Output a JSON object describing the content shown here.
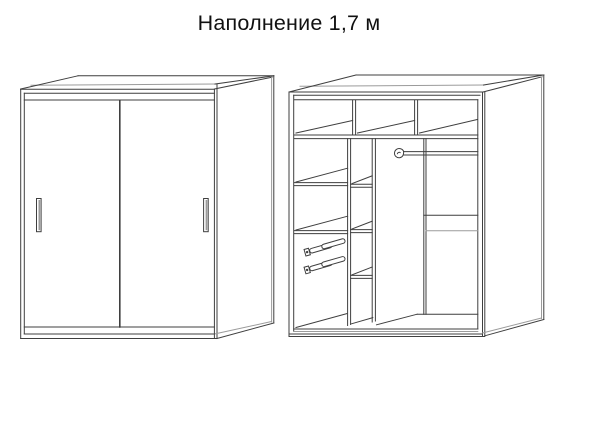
{
  "title": "Наполнение 1,7 м",
  "diagram": {
    "type": "furniture-line-drawing",
    "views": [
      {
        "id": "closed-wardrobe-view",
        "parts": [
          "cabinet-top",
          "side-panel",
          "left-sliding-door",
          "right-sliding-door",
          "left-door-handle",
          "right-door-handle",
          "base-plinth"
        ]
      },
      {
        "id": "interior-view",
        "parts": [
          "cabinet-top",
          "side-panel",
          "top-shelf",
          "upper-compartment-divider-1",
          "upper-compartment-divider-2",
          "left-partition",
          "middle-partition",
          "right-divider",
          "left-shelf-1",
          "left-shelf-2",
          "narrow-shelf-1",
          "narrow-shelf-2",
          "narrow-shelf-3",
          "drawer-slide-1",
          "drawer-slide-2",
          "hanging-rod",
          "rod-bracket",
          "right-shelf",
          "cabinet-floor"
        ]
      }
    ]
  },
  "colors": {
    "background": "#ffffff",
    "line": "#3f3f3f",
    "line_light": "#9b9b9b",
    "text": "#111111"
  }
}
